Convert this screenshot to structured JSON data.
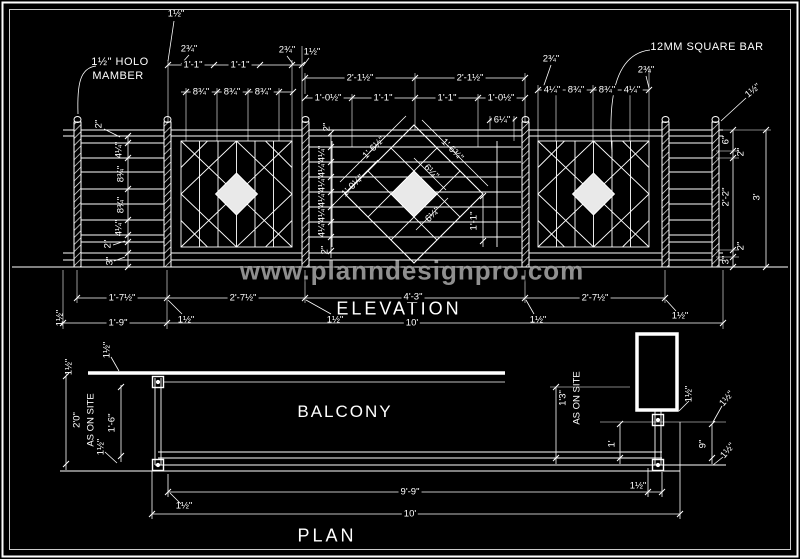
{
  "colors": {
    "background": "#000000",
    "line": "#ffffff",
    "watermark": "#9c9c9c",
    "panel_fill": "#e9e9e9"
  },
  "watermark": "www.planndesignpro.com",
  "titles": {
    "elevation": "ELEVATION",
    "plan": "PLAN",
    "balcony": "BALCONY"
  },
  "callouts": {
    "holo_line1": "1½\" HOLO",
    "holo_line2": "MAMBER",
    "square_bar": "12MM SQUARE BAR"
  },
  "labels": [
    {
      "t": "1½\"",
      "x": 176,
      "y": 14
    },
    {
      "t": "2¾\"",
      "x": 189,
      "y": 49
    },
    {
      "t": "1'-1\"",
      "x": 193,
      "y": 65,
      "bg": 1
    },
    {
      "t": "1'-1\"",
      "x": 240,
      "y": 65,
      "bg": 1
    },
    {
      "t": "2¾\"",
      "x": 287,
      "y": 50
    },
    {
      "t": "1½\"",
      "x": 312,
      "y": 52
    },
    {
      "t": "8¾\"",
      "x": 201,
      "y": 92,
      "bg": 1
    },
    {
      "t": "8¾\"",
      "x": 232,
      "y": 92,
      "bg": 1
    },
    {
      "t": "8¾\"",
      "x": 263,
      "y": 92,
      "bg": 1
    },
    {
      "t": "2'-1½\"",
      "x": 360,
      "y": 78,
      "bg": 1
    },
    {
      "t": "2'-1½\"",
      "x": 470,
      "y": 78,
      "bg": 1
    },
    {
      "t": "1'-0½\"",
      "x": 328,
      "y": 98,
      "bg": 1
    },
    {
      "t": "1'-1\"",
      "x": 383,
      "y": 98,
      "bg": 1
    },
    {
      "t": "1'-1\"",
      "x": 447,
      "y": 98,
      "bg": 1
    },
    {
      "t": "1'-0½\"",
      "x": 501,
      "y": 98,
      "bg": 1
    },
    {
      "t": "6¼\"",
      "x": 502,
      "y": 120,
      "bg": 1
    },
    {
      "t": "2¾\"",
      "x": 551,
      "y": 59
    },
    {
      "t": "4¼\"",
      "x": 552,
      "y": 90,
      "bg": 1
    },
    {
      "t": "8¾\"",
      "x": 576,
      "y": 90,
      "bg": 1
    },
    {
      "t": "8¾\"",
      "x": 607,
      "y": 90,
      "bg": 1
    },
    {
      "t": "4¼\"",
      "x": 632,
      "y": 90,
      "bg": 1
    },
    {
      "t": "2¾\"",
      "x": 646,
      "y": 70
    },
    {
      "t": "1½\"",
      "x": 753,
      "y": 91,
      "r": -40
    },
    {
      "t": "2\"",
      "x": 99,
      "y": 124,
      "r": -90
    },
    {
      "t": "4¼\"",
      "x": 119,
      "y": 150,
      "r": -90
    },
    {
      "t": "8¾\"",
      "x": 121,
      "y": 174,
      "r": -90
    },
    {
      "t": "8¾\"",
      "x": 121,
      "y": 205,
      "r": -90
    },
    {
      "t": "4¼\"",
      "x": 119,
      "y": 228,
      "r": -90
    },
    {
      "t": "2\"",
      "x": 108,
      "y": 244,
      "r": -90
    },
    {
      "t": "3\"",
      "x": 110,
      "y": 261,
      "r": -90
    },
    {
      "t": "1½\"",
      "x": 60,
      "y": 318,
      "r": -90
    },
    {
      "t": "2\"",
      "x": 327,
      "y": 127,
      "r": -90
    },
    {
      "t": "4¼\"",
      "x": 322,
      "y": 154,
      "r": -90
    },
    {
      "t": "4¼\"",
      "x": 322,
      "y": 169,
      "r": -90
    },
    {
      "t": "4¼\"",
      "x": 322,
      "y": 184,
      "r": -90
    },
    {
      "t": "4¼\"",
      "x": 322,
      "y": 199,
      "r": -90
    },
    {
      "t": "4¼\"",
      "x": 322,
      "y": 214,
      "r": -90
    },
    {
      "t": "4¼\"",
      "x": 322,
      "y": 229,
      "r": -90
    },
    {
      "t": "2\"",
      "x": 325,
      "y": 250,
      "r": -90
    },
    {
      "t": "1'-6½\"",
      "x": 374,
      "y": 148,
      "r": -45
    },
    {
      "t": "1'-0¼\"",
      "x": 353,
      "y": 186,
      "r": -45
    },
    {
      "t": "1'-6¾\"",
      "x": 452,
      "y": 150,
      "r": 45
    },
    {
      "t": "6¼\"",
      "x": 431,
      "y": 172,
      "r": 45
    },
    {
      "t": "6¼\"",
      "x": 433,
      "y": 215,
      "r": -45
    },
    {
      "t": "1'-1\"",
      "x": 474,
      "y": 221,
      "r": -90
    },
    {
      "t": "6\"",
      "x": 726,
      "y": 140,
      "r": -90
    },
    {
      "t": "2\"",
      "x": 741,
      "y": 152,
      "r": -90
    },
    {
      "t": "2'-2\"",
      "x": 726,
      "y": 197,
      "r": -90
    },
    {
      "t": "2\"",
      "x": 741,
      "y": 246,
      "r": -90
    },
    {
      "t": "3\"",
      "x": 726,
      "y": 260,
      "r": -90
    },
    {
      "t": "3'",
      "x": 757,
      "y": 197,
      "r": -90
    },
    {
      "t": "1'-7½\"",
      "x": 122,
      "y": 298,
      "bg": 1
    },
    {
      "t": "2'-7½\"",
      "x": 243,
      "y": 298,
      "bg": 1
    },
    {
      "t": "4'-3\"",
      "x": 413,
      "y": 297,
      "bg": 1
    },
    {
      "t": "2'-7½\"",
      "x": 595,
      "y": 298,
      "bg": 1
    },
    {
      "t": "1½\"",
      "x": 186,
      "y": 320
    },
    {
      "t": "1½\"",
      "x": 335,
      "y": 320
    },
    {
      "t": "1½\"",
      "x": 538,
      "y": 320
    },
    {
      "t": "1½\"",
      "x": 680,
      "y": 316
    },
    {
      "t": "1'-9\"",
      "x": 118,
      "y": 323,
      "bg": 1
    },
    {
      "t": "10'",
      "x": 412,
      "y": 323,
      "bg": 1
    },
    {
      "t": "1½\"",
      "x": 107,
      "y": 350,
      "r": -90
    },
    {
      "t": "1½\"",
      "x": 69,
      "y": 367,
      "r": -90
    },
    {
      "t": "2'0\"",
      "x": 77,
      "y": 420,
      "r": -90
    },
    {
      "t": "AS ON SITE",
      "x": 91,
      "y": 420,
      "r": -90
    },
    {
      "t": "1½\"",
      "x": 101,
      "y": 447,
      "r": -90
    },
    {
      "t": "1'-6\"",
      "x": 112,
      "y": 423,
      "r": -90
    },
    {
      "t": "1'3\"",
      "x": 563,
      "y": 398,
      "r": -90
    },
    {
      "t": "AS ON SITE",
      "x": 577,
      "y": 398,
      "r": -90
    },
    {
      "t": "1'",
      "x": 612,
      "y": 444,
      "r": -90
    },
    {
      "t": "9\"",
      "x": 703,
      "y": 444,
      "r": -90
    },
    {
      "t": "1½\"",
      "x": 689,
      "y": 394,
      "r": -90
    },
    {
      "t": "1½\"",
      "x": 727,
      "y": 399,
      "r": -50
    },
    {
      "t": "1½\"",
      "x": 728,
      "y": 451,
      "r": -50
    },
    {
      "t": "9'-9\"",
      "x": 410,
      "y": 492,
      "bg": 1
    },
    {
      "t": "1½\"",
      "x": 638,
      "y": 486
    },
    {
      "t": "10'",
      "x": 410,
      "y": 514,
      "bg": 1
    },
    {
      "t": "1½\"",
      "x": 184,
      "y": 506
    }
  ]
}
